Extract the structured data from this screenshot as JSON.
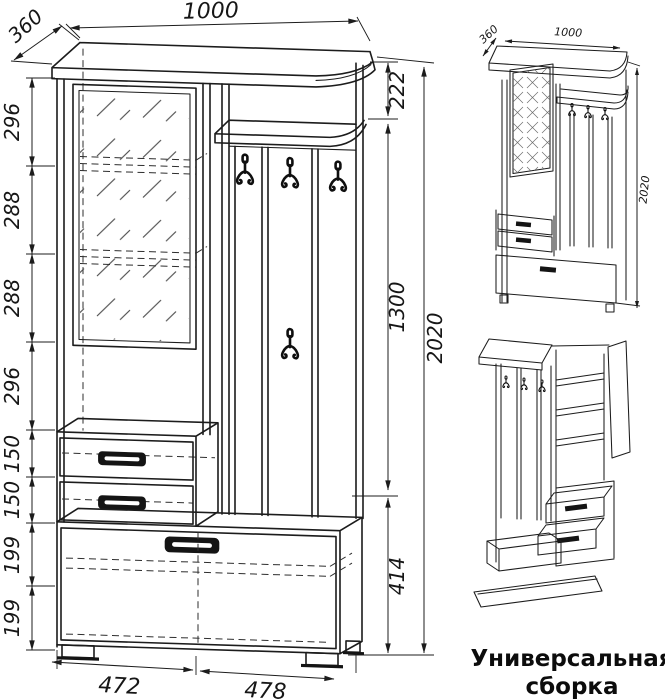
{
  "main_view": {
    "dim_width_top": "1000",
    "dim_depth": "360",
    "left_dims": [
      "296",
      "288",
      "288",
      "296",
      "150",
      "150",
      "199",
      "199"
    ],
    "right_dims": [
      "222",
      "1300",
      "414"
    ],
    "dim_total_height": "2020",
    "bottom_dims": [
      "472",
      "478"
    ]
  },
  "iso_view": {
    "dim_depth": "360",
    "dim_width": "1000",
    "dim_height": "2020",
    "caption_line1": "Универсальная",
    "caption_line2": "сборка"
  },
  "colors": {
    "line": "#1c1c1c",
    "hatch": "#4a4a4a",
    "background": "#ffffff"
  }
}
